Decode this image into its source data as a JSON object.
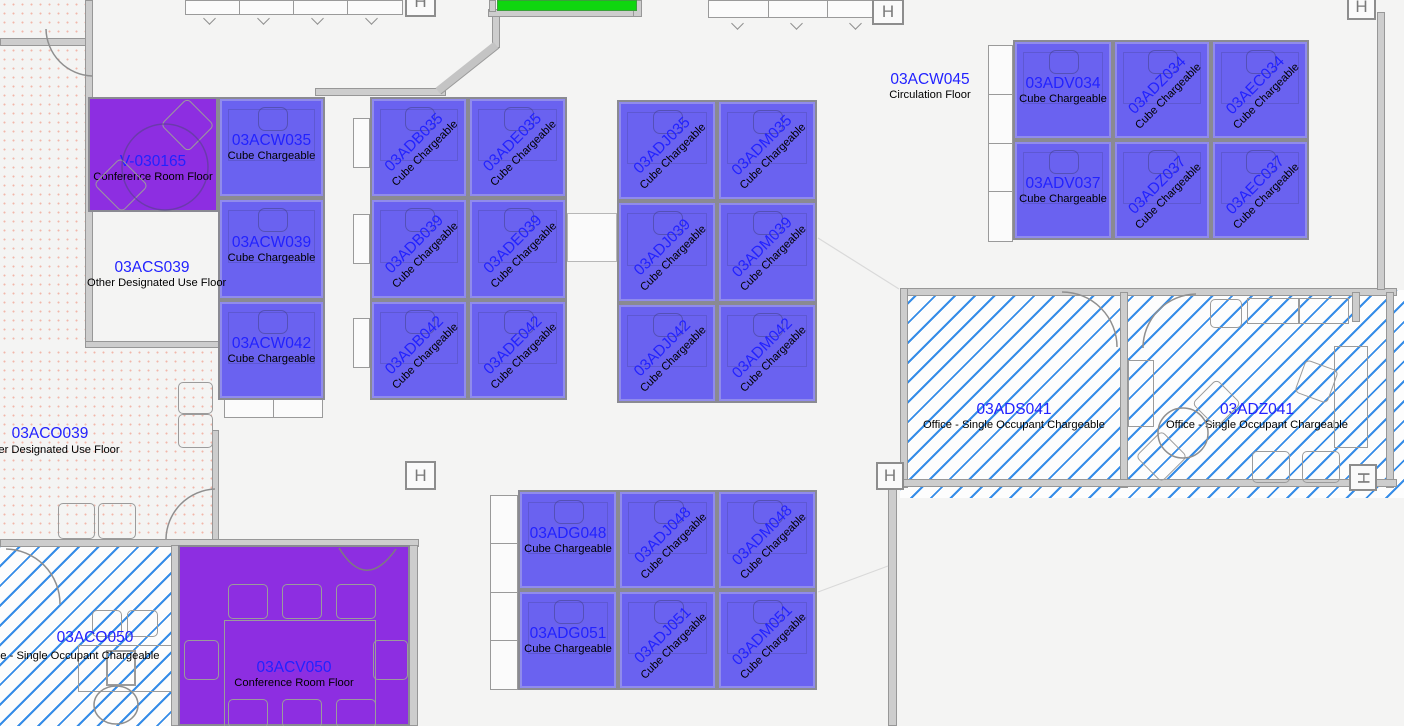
{
  "colors": {
    "cube_fill": "#6a62f0",
    "conference_purple": "#8d2ee1",
    "hatch_line": "#2e8be4",
    "highlight_green": "#0fd60f",
    "room_code_text": "#2222ff",
    "room_type_text": "#000000"
  },
  "symbols": {
    "column_marker": "H"
  },
  "rooms": {
    "v030165": {
      "code": "V-030165",
      "type": "Conference Room Floor"
    },
    "acs039": {
      "code": "03ACS039",
      "type": "Other Designated Use Floor"
    },
    "aco039": {
      "code": "03ACO039",
      "type": "Other Designated Use Floor"
    },
    "acw045": {
      "code": "03ACW045",
      "type": "Circulation Floor"
    },
    "ads041": {
      "code": "03ADS041",
      "type": "Office - Single Occupant Chargeable"
    },
    "adz041": {
      "code": "03ADZ041",
      "type": "Office - Single Occupant Chargeable"
    },
    "aco050": {
      "code": "03ACO050",
      "type": "Office - Single Occupant Chargeable"
    },
    "acv050": {
      "code": "03ACV050",
      "type": "Conference Room Floor"
    }
  },
  "cubes": {
    "acw035": {
      "code": "03ACW035",
      "type": "Cube Chargeable"
    },
    "acw039": {
      "code": "03ACW039",
      "type": "Cube Chargeable"
    },
    "acw042": {
      "code": "03ACW042",
      "type": "Cube Chargeable"
    },
    "adb035": {
      "code": "03ADB035",
      "type": "Cube Chargeable"
    },
    "ade035": {
      "code": "03ADE035",
      "type": "Cube Chargeable"
    },
    "adb039": {
      "code": "03ADB039",
      "type": "Cube Chargeable"
    },
    "ade039": {
      "code": "03ADE039",
      "type": "Cube Chargeable"
    },
    "adb042": {
      "code": "03ADB042",
      "type": "Cube Chargeable"
    },
    "ade042": {
      "code": "03ADE042",
      "type": "Cube Chargeable"
    },
    "adj035": {
      "code": "03ADJ035",
      "type": "Cube Chargeable"
    },
    "adm035": {
      "code": "03ADM035",
      "type": "Cube Chargeable"
    },
    "adj039": {
      "code": "03ADJ039",
      "type": "Cube Chargeable"
    },
    "adm039": {
      "code": "03ADM039",
      "type": "Cube Chargeable"
    },
    "adj042": {
      "code": "03ADJ042",
      "type": "Cube Chargeable"
    },
    "adm042": {
      "code": "03ADM042",
      "type": "Cube Chargeable"
    },
    "adv034": {
      "code": "03ADV034",
      "type": "Cube Chargeable"
    },
    "adz034": {
      "code": "03ADZ034",
      "type": "Cube Chargeable"
    },
    "aec034": {
      "code": "03AEC034",
      "type": "Cube Chargeable"
    },
    "adv037": {
      "code": "03ADV037",
      "type": "Cube Chargeable"
    },
    "adz037": {
      "code": "03ADZ037",
      "type": "Cube Chargeable"
    },
    "aec037": {
      "code": "03AEC037",
      "type": "Cube Chargeable"
    },
    "adg048": {
      "code": "03ADG048",
      "type": "Cube Chargeable"
    },
    "adj048": {
      "code": "03ADJ048",
      "type": "Cube Chargeable"
    },
    "adm048": {
      "code": "03ADM048",
      "type": "Cube Chargeable"
    },
    "adg051": {
      "code": "03ADG051",
      "type": "Cube Chargeable"
    },
    "adj051": {
      "code": "03ADJ051",
      "type": "Cube Chargeable"
    },
    "adm051": {
      "code": "03ADM051",
      "type": "Cube Chargeable"
    }
  }
}
